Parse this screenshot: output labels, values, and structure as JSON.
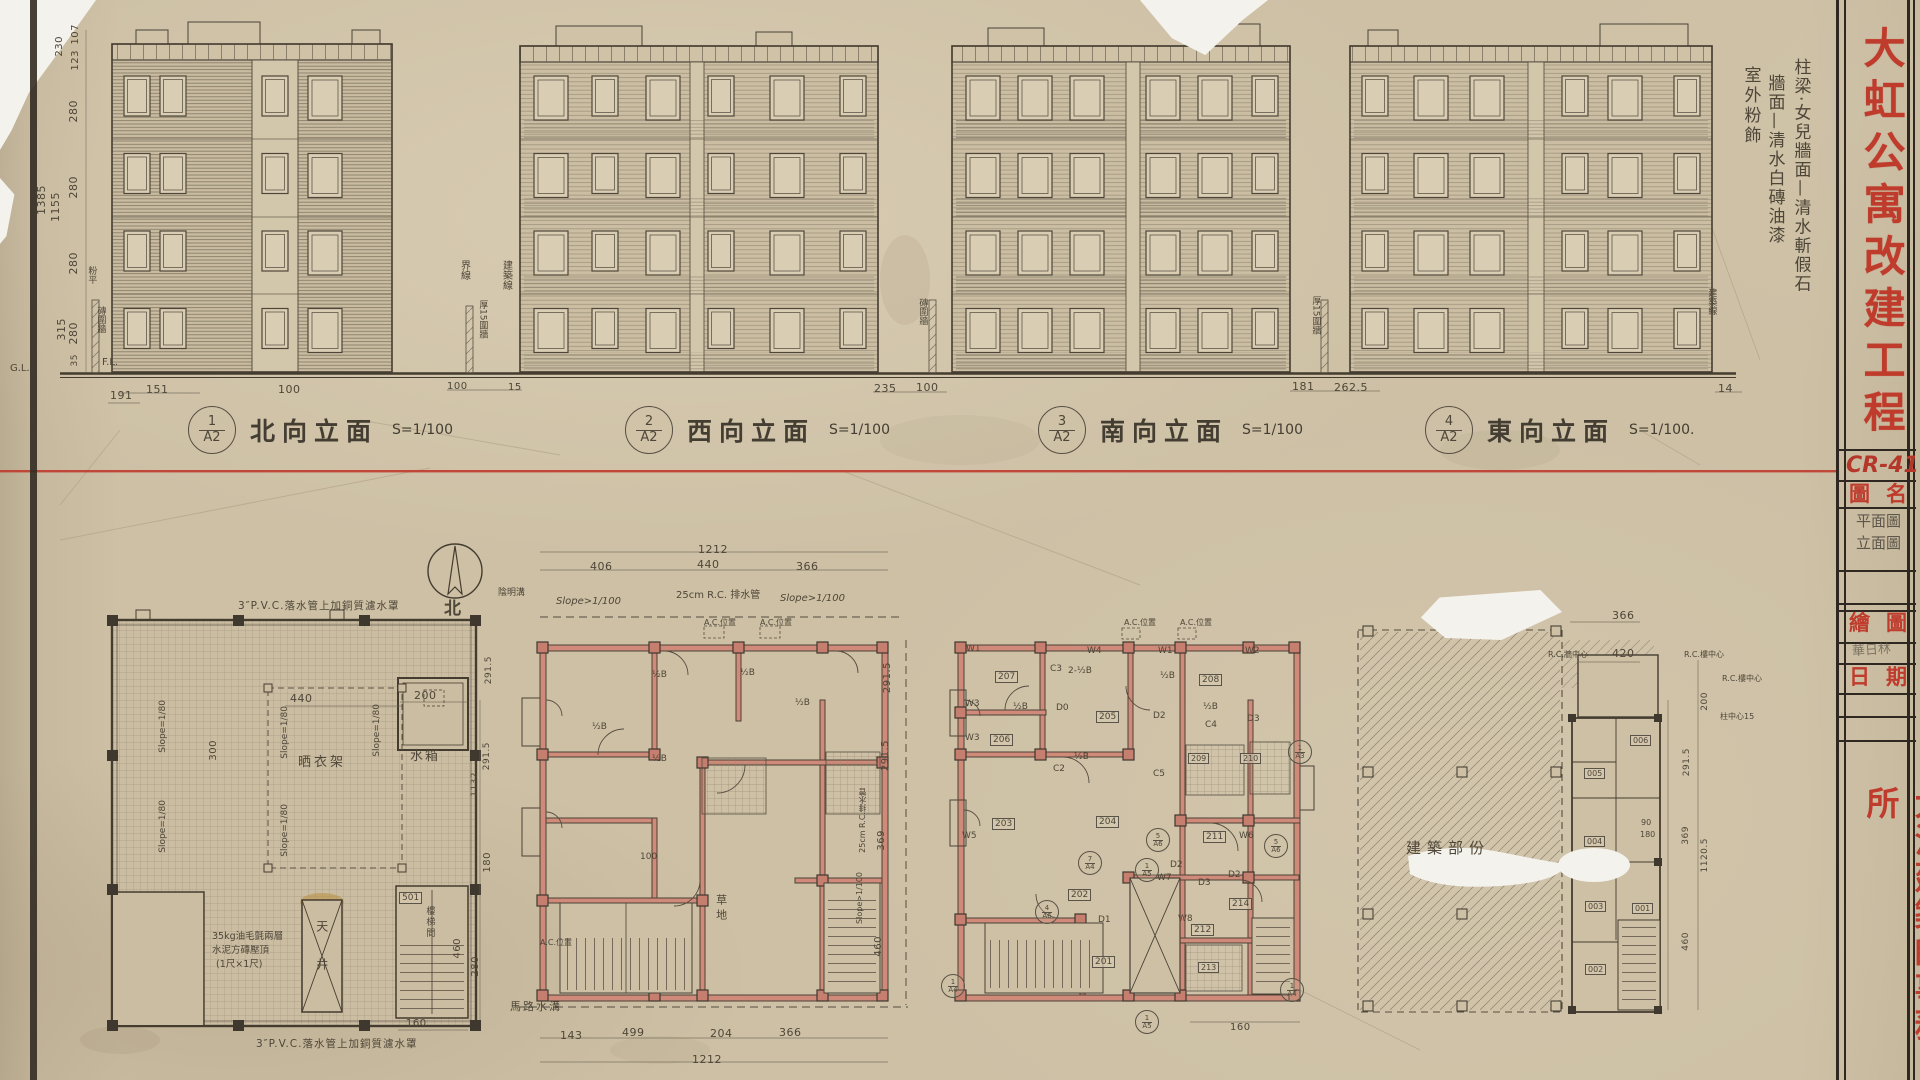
{
  "sheet": {
    "project_title": "大虹公寓改建工程",
    "drawing_no": "CR-411",
    "firm": "大洪建築師事務所",
    "titleblock": {
      "name_label": "圖名",
      "name_value_line1": "平面圖",
      "name_value_line2": "立面圖",
      "draw_label": "繪圖",
      "draw_value": "華日林",
      "date_label": "日期"
    },
    "accent_red": "#bf3b2c",
    "pencil": "#4e4638"
  },
  "finish_notes": {
    "line1": "柱梁·女兒牆面—清水斬假石",
    "line2": "牆面—清水白磚油漆",
    "line3": "室外粉飾"
  },
  "elevation_captions": [
    {
      "num": "1",
      "sheet": "A2",
      "title": "北向立面",
      "scale": "S=1/100"
    },
    {
      "num": "2",
      "sheet": "A2",
      "title": "西向立面",
      "scale": "S=1/100"
    },
    {
      "num": "3",
      "sheet": "A2",
      "title": "南向立面",
      "scale": "S=1/100"
    },
    {
      "num": "4",
      "sheet": "A2",
      "title": "東向立面",
      "scale": "S=1/100."
    }
  ],
  "site_notes": {
    "boundary": "界線",
    "building_line": "建築線",
    "wall_15": "厚15圍牆",
    "brick_wall": "磚圍牆",
    "plaster": "粉平",
    "fl": "F.L.",
    "gl": "G.L."
  },
  "left_dims": {
    "d107": "107",
    "d123": "123",
    "d230": "230",
    "d280a": "280",
    "d280b": "280",
    "d280c": "280",
    "d280d": "280",
    "d315": "315",
    "d35": "35",
    "total1": "1385",
    "total2": "1155",
    "base": "191"
  },
  "ground_dims": {
    "e1a": "151",
    "e1b": "100",
    "f1": "100",
    "f2": "15",
    "e23a": "235",
    "e23b": "100",
    "e34a": "181",
    "e34b": "262.5",
    "right": "14"
  },
  "compass": {
    "label": "北"
  },
  "roof_plan": {
    "note_top": "3″P.V.C.落水管上加銅質濾水罩",
    "note_bottom": "3″P.V.C.落水管上加銅質濾水罩",
    "note_slab1": "35kg油毛氈兩層",
    "note_slab2": "水泥方磚壓頂",
    "note_slab3": "(1尺×1尺)",
    "water_tank": "水箱",
    "drying_rack": "晒衣架",
    "lightwell": "天井",
    "stair_no": "501",
    "stair": "樓梯間",
    "slope": "Slope=1/80",
    "dims": {
      "a": "440",
      "b": "200",
      "c": "300",
      "d": "180",
      "e": "460",
      "f": "280",
      "g": "160",
      "h": "291.5",
      "i": "291.5",
      "j": "1132"
    }
  },
  "plan_b": {
    "dims_top": {
      "total": "1212",
      "a": "406",
      "b": "440",
      "c": "366"
    },
    "dims_bottom": {
      "a": "143",
      "b": "499",
      "c": "204",
      "d": "366",
      "total": "1212"
    },
    "dims_right": {
      "a": "291.5",
      "b": "291.5",
      "c": "369",
      "d": "460"
    },
    "notes": {
      "slope_l": "Slope>1/100",
      "drain": "25cm R.C. 排水管",
      "slope_r": "Slope>1/100",
      "gutter": "陰明溝",
      "ac": "A.C.位置",
      "road": "馬路水溝",
      "lawn": "草地",
      "half_b": "½B",
      "dim100": "100",
      "drain_v": "25cm R.C.排水管",
      "slope_v": "Slope>1/100"
    }
  },
  "plan_c": {
    "rooms": [
      "201",
      "202",
      "203",
      "204",
      "205",
      "206",
      "207",
      "208",
      "209",
      "210",
      "211",
      "212",
      "213",
      "214"
    ],
    "windows": {
      "w1": "W1",
      "w2": "W2",
      "w3": "W3",
      "w4": "W4",
      "w5": "W5",
      "w6": "W6",
      "w7": "W7",
      "w8": "W8"
    },
    "cols": {
      "c2": "C2",
      "c3": "C3",
      "c4": "C4",
      "c5": "C5"
    },
    "col_note": "2-½B",
    "doors": {
      "d0": "D0",
      "d1": "D1",
      "d2": "D2",
      "d3": "D3"
    },
    "ac": "A.C.位置",
    "half_b": "½B",
    "dim160": "160",
    "marks": {
      "m1": {
        "n": "1",
        "s": "A3"
      },
      "m2": {
        "n": "4",
        "s": "A6"
      },
      "m3": {
        "n": "5",
        "s": "A6"
      },
      "m4": {
        "n": "7",
        "s": "A4"
      },
      "m5": {
        "n": "1",
        "s": "A5"
      },
      "m6": {
        "n": "1",
        "s": "A4"
      },
      "m7": {
        "n": "5",
        "s": "A6"
      }
    }
  },
  "plan_d": {
    "area_label": "建築部份",
    "rooms": [
      "001",
      "002",
      "003",
      "004",
      "005",
      "006"
    ],
    "notes": {
      "rc_wall": "R.C.牆中心",
      "rc_floor": "R.C.樓中心",
      "rc_floor2": "R.C.樓中心",
      "col_center": "柱中心15"
    },
    "dims": {
      "a": "366",
      "b": "420",
      "c": "200",
      "d": "291.5",
      "e": "369",
      "f": "1120.5",
      "g": "460",
      "h": "90",
      "i": "180"
    }
  }
}
